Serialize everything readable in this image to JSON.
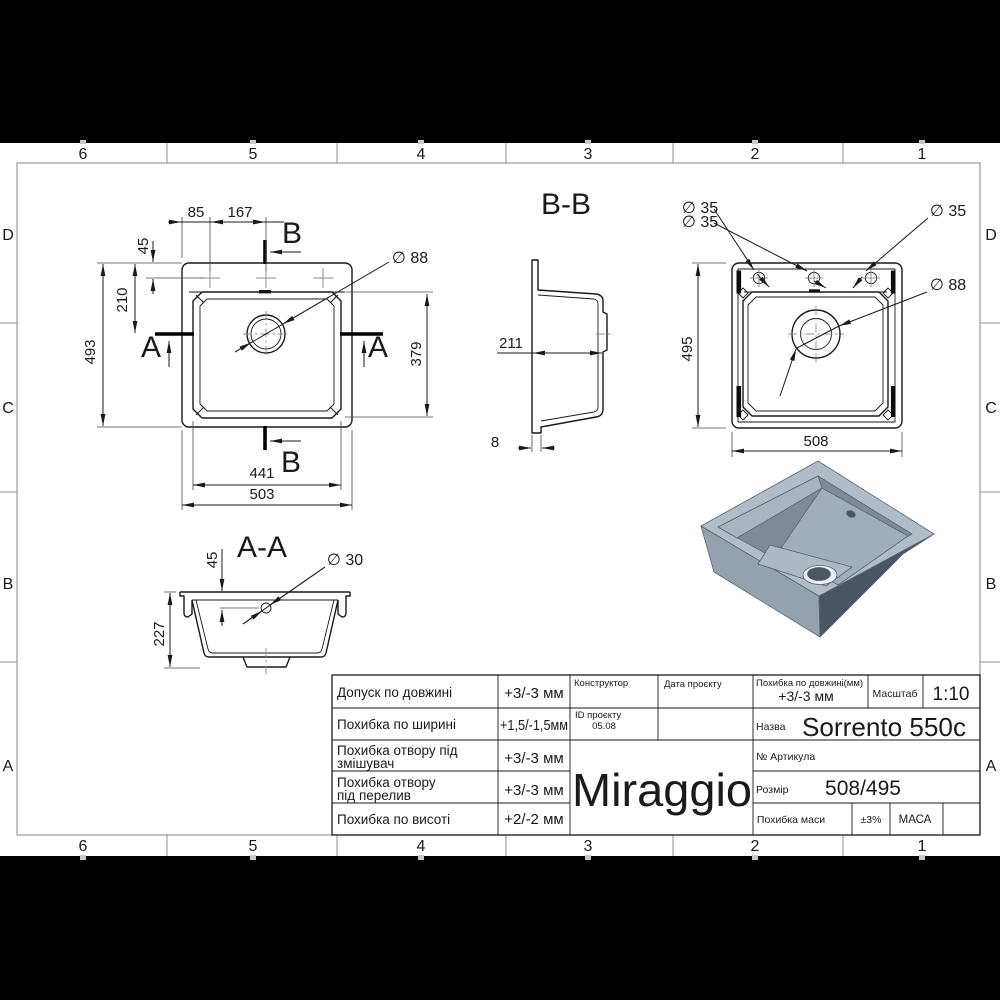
{
  "frame": {
    "columns": [
      "6",
      "5",
      "4",
      "3",
      "2",
      "1"
    ],
    "rows": [
      "D",
      "C",
      "B",
      "A"
    ]
  },
  "top_view": {
    "section_b": "B",
    "section_a": "A",
    "dia_drain": "∅ 88",
    "dim_85": "85",
    "dim_167": "167",
    "dim_45": "45",
    "dim_210": "210",
    "dim_493": "493",
    "dim_379": "379",
    "dim_441": "441",
    "dim_503": "503"
  },
  "section_bb": {
    "title": "B-B",
    "dim_depth": "211",
    "dim_flange": "8"
  },
  "bottom_view": {
    "dia_holes": [
      "∅ 35",
      "∅ 35",
      "∅ 35"
    ],
    "dia_drain": "∅ 88",
    "dim_495": "495",
    "dim_508": "508"
  },
  "section_aa": {
    "title": "A-A",
    "dim_45": "45",
    "dia_hole": "∅ 30",
    "dim_227": "227"
  },
  "title_block": {
    "tolerances": [
      {
        "label1": "Допуск по довжині",
        "label2": "",
        "value": "+3/-3 мм"
      },
      {
        "label1": "Похибка по ширині",
        "label2": "",
        "value": "+1,5/-1,5мм"
      },
      {
        "label1": "Похибка отвору під",
        "label2": "змішувач",
        "value": "+3/-3 мм"
      },
      {
        "label1": "Похибка отвору",
        "label2": "під перелив",
        "value": "+3/-3 мм"
      },
      {
        "label1": "Похибка по висоті",
        "label2": "",
        "value": "+2/-2 мм"
      }
    ],
    "constructor_label": "Конструктор",
    "date_label": "Дата проєкту",
    "project_id_label": "ID проєкту",
    "project_id_value": "05.08",
    "logo": "Miraggio",
    "length_tolerance_label": "Похибка по довжині(мм)",
    "length_tolerance_value": "+3/-3 мм",
    "scale_label": "Масштаб",
    "scale_value": "1:10",
    "name_label": "Назва",
    "name_value": "Sorrento 550c",
    "article_label": "№ Артикула",
    "size_label": "Розмір",
    "size_value": "508/495",
    "mass_tolerance_label": "Похибка маси",
    "mass_tolerance_value": "±3%",
    "mass_label": "МАСА"
  }
}
